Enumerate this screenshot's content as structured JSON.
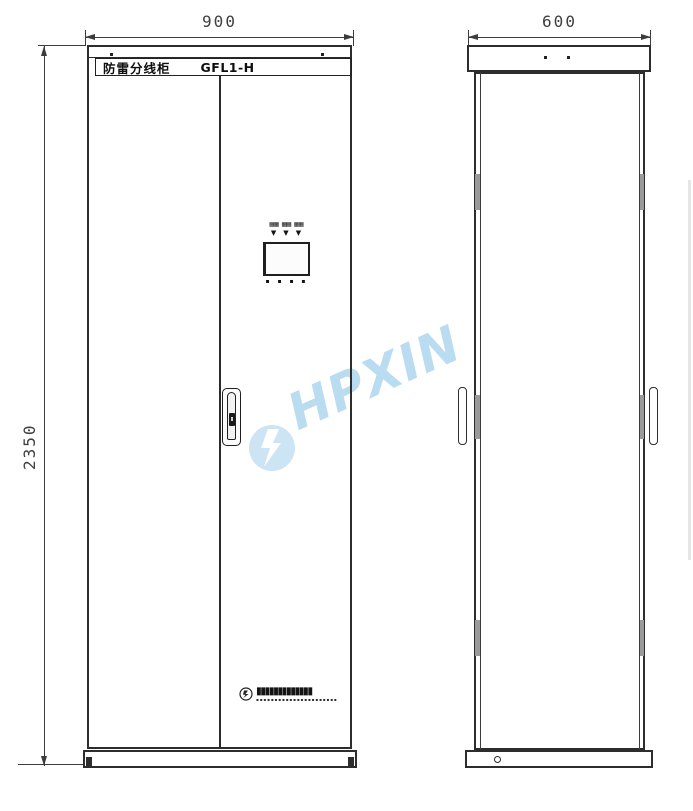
{
  "watermark": {
    "text": "HPXIN",
    "color": "#b9dcf0"
  },
  "front_view": {
    "width_dim": "900",
    "height_dim": "2350",
    "nameplate": {
      "title": "防雷分线柜",
      "model": "GFL1-H"
    },
    "panel": {
      "indicators": [
        "▦▦",
        "▦▦",
        "▦▦"
      ],
      "pointers": [
        "▼",
        "▼",
        "▼"
      ],
      "buttons": "▪ ▪ ▪ ▪"
    },
    "brand": {
      "name_blocks": "▮▮▮▮▮▮▮▮▮▮▮▮▮",
      "sub_blocks": "▪▪▪▪▪▪▪▪▪▪▪▪▪▪▪▪▪▪▪▪▪▪"
    }
  },
  "side_view": {
    "width_dim": "600"
  }
}
